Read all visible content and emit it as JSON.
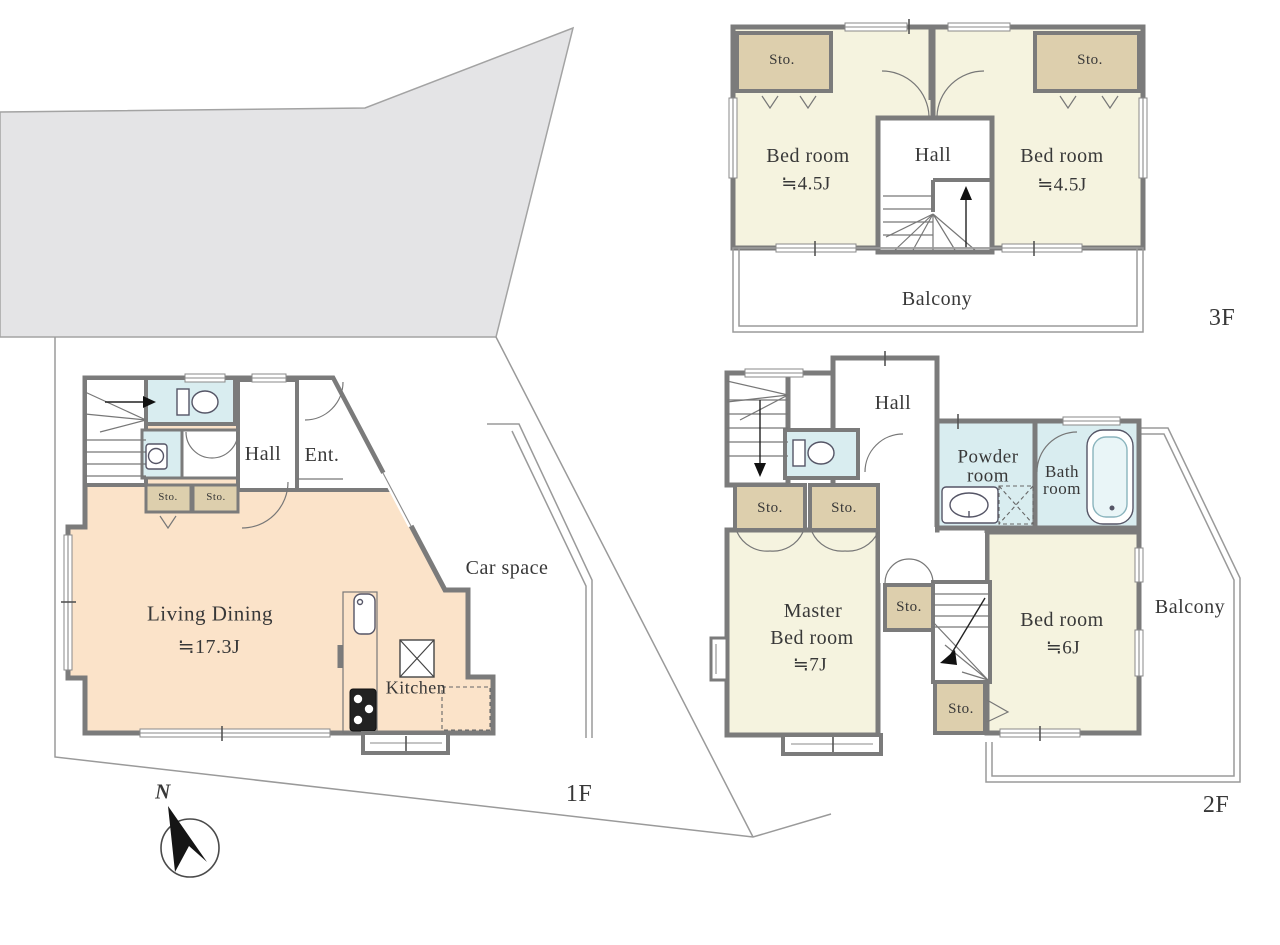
{
  "colors": {
    "wall": "#7b7b7b",
    "room_cream": "#f5f3df",
    "room_tan": "#ddcfad",
    "room_peach": "#fbe3c9",
    "room_blue": "#d9edf0",
    "site_gray": "#e4e4e6",
    "line": "#9a9a9a",
    "text": "#383838"
  },
  "site": {
    "north_label": "N",
    "car_space_label": "Car space"
  },
  "floor1": {
    "floor_label": "1F",
    "rooms": {
      "hall": "Hall",
      "entrance": "Ent.",
      "storage1": "Sto.",
      "storage2": "Sto.",
      "living_dining_name": "Living Dining",
      "living_dining_size": "≒17.3J",
      "kitchen": "Kitchen"
    }
  },
  "floor2": {
    "floor_label": "2F",
    "rooms": {
      "hall": "Hall",
      "powder_room_line1": "Powder",
      "powder_room_line2": "room",
      "bath_room_line1": "Bath",
      "bath_room_line2": "room",
      "storage1": "Sto.",
      "storage2": "Sto.",
      "storage3": "Sto.",
      "storage4": "Sto.",
      "master_bedroom_line1": "Master",
      "master_bedroom_line2": "Bed room",
      "master_bedroom_size": "≒7J",
      "bedroom_name": "Bed room",
      "bedroom_size": "≒6J",
      "balcony": "Balcony"
    }
  },
  "floor3": {
    "floor_label": "3F",
    "rooms": {
      "storage1": "Sto.",
      "storage2": "Sto.",
      "bedroom_left_name": "Bed room",
      "bedroom_left_size": "≒4.5J",
      "bedroom_right_name": "Bed room",
      "bedroom_right_size": "≒4.5J",
      "hall": "Hall",
      "balcony": "Balcony"
    }
  }
}
